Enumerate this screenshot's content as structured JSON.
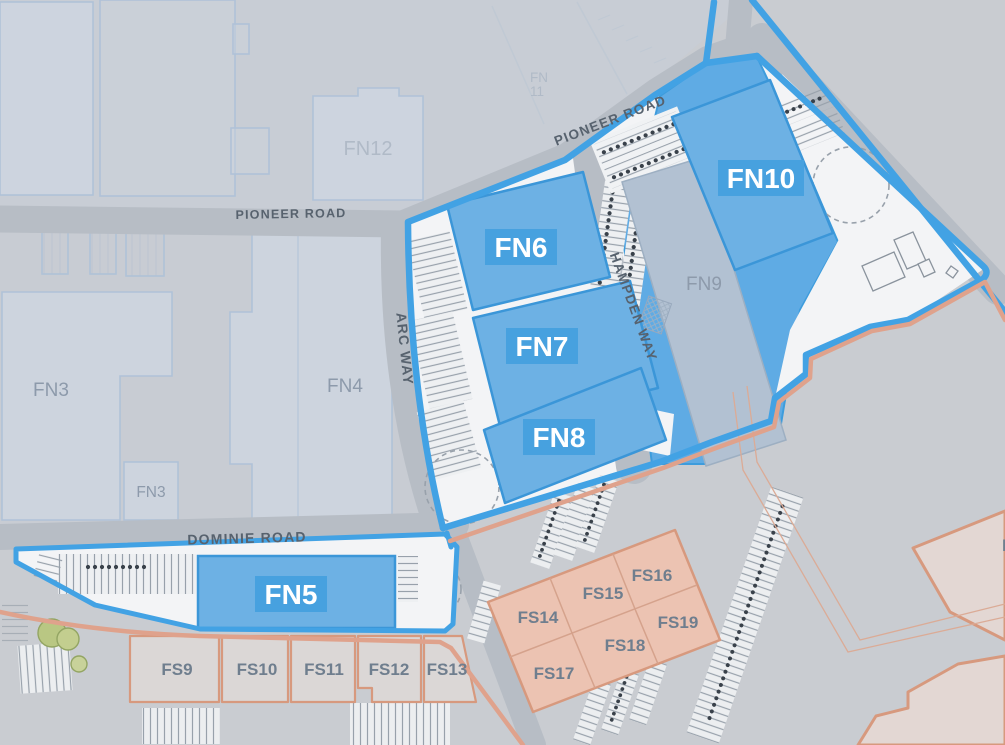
{
  "map": {
    "roads": {
      "pioneer_left": "PIONEER ROAD",
      "pioneer_diagonal": "PIONEER ROAD",
      "arc_way": "ARC WAY",
      "hampden_way": "HAMPDEN WAY",
      "dominie_road": "DOMINIE ROAD"
    },
    "available_units": {
      "fn5": "FN5",
      "fn6": "FN6",
      "fn7": "FN7",
      "fn8": "FN8",
      "fn10": "FN10"
    },
    "context_units": {
      "fn3_main": "FN3",
      "fn3_small": "FN3",
      "fn4": "FN4",
      "fn9": "FN9",
      "fn11_line1": "FN",
      "fn11_line2": "11",
      "fn12": "FN12"
    },
    "neighbouring_units": {
      "fs9": "FS9",
      "fs10": "FS10",
      "fs11": "FS11",
      "fs12": "FS12",
      "fs13": "FS13",
      "fs14": "FS14",
      "fs15": "FS15",
      "fs16": "FS16",
      "fs17": "FS17",
      "fs18": "FS18",
      "fs19": "FS19"
    },
    "partial_label": "F",
    "colors": {
      "available_fill": "#6db1e4",
      "available_badge": "#47a1df",
      "boundary_blue": "#42a2e4",
      "zone_blue": "#5fabe4",
      "salmon_boundary": "#dfa28c",
      "salmon_block_fill": "#ecc3b2",
      "road_gray": "#b7bdc5",
      "base_gray": "#c9ccd1",
      "parcel_white": "#f3f4f6"
    }
  }
}
